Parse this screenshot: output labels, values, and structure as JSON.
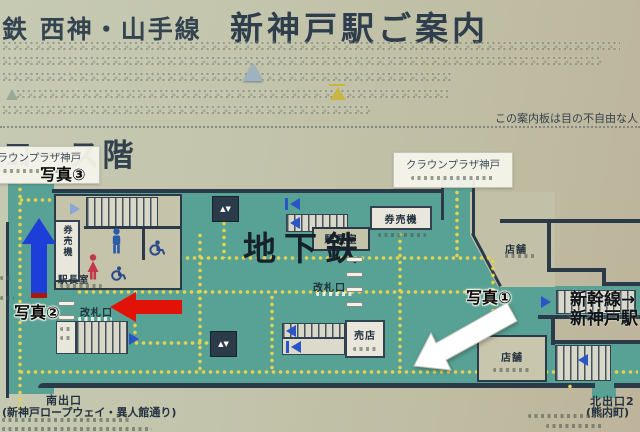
{
  "header": {
    "line_small": "鉄  西神・山手線",
    "title": "新神戸駅ご案内",
    "accessibility_note": "この案内板は目の不自由な人"
  },
  "floor": {
    "label": "コース階"
  },
  "hotel_labels": {
    "left": "クラウンプラザ神戸",
    "right": "クラウンプラザ神戸"
  },
  "photos": {
    "p1": "写真①",
    "p2": "写真②",
    "p3": "写真③"
  },
  "map": {
    "subway": "地下鉄",
    "shinkansen_line1": "新幹線→",
    "shinkansen_line2": "新神戸駅",
    "ticket_machine_left": "券売機",
    "ticket_machine_top": "券売機",
    "stationmaster_left": "駅長室",
    "stationmaster_top": "駅長室",
    "gate_left": "改札口",
    "gate_center": "改札口",
    "kiosk": "売店",
    "shop_upper": "店舗",
    "shop_lower": "店舗",
    "south_exit": "南出口",
    "south_exit_note": "(新神戸ロープウェイ・異人館通り)",
    "north_exit": "北出口2",
    "north_exit_note": "(熊内町)"
  },
  "colors": {
    "board": "#c3c6ae",
    "floor_teal": "#57a295",
    "wall": "#2b3a49",
    "tactile_yellow": "#e3d252",
    "arrow_red": "#e11207",
    "arrow_blue": "#1d3fd8",
    "arrow_white": "#ffffff"
  }
}
